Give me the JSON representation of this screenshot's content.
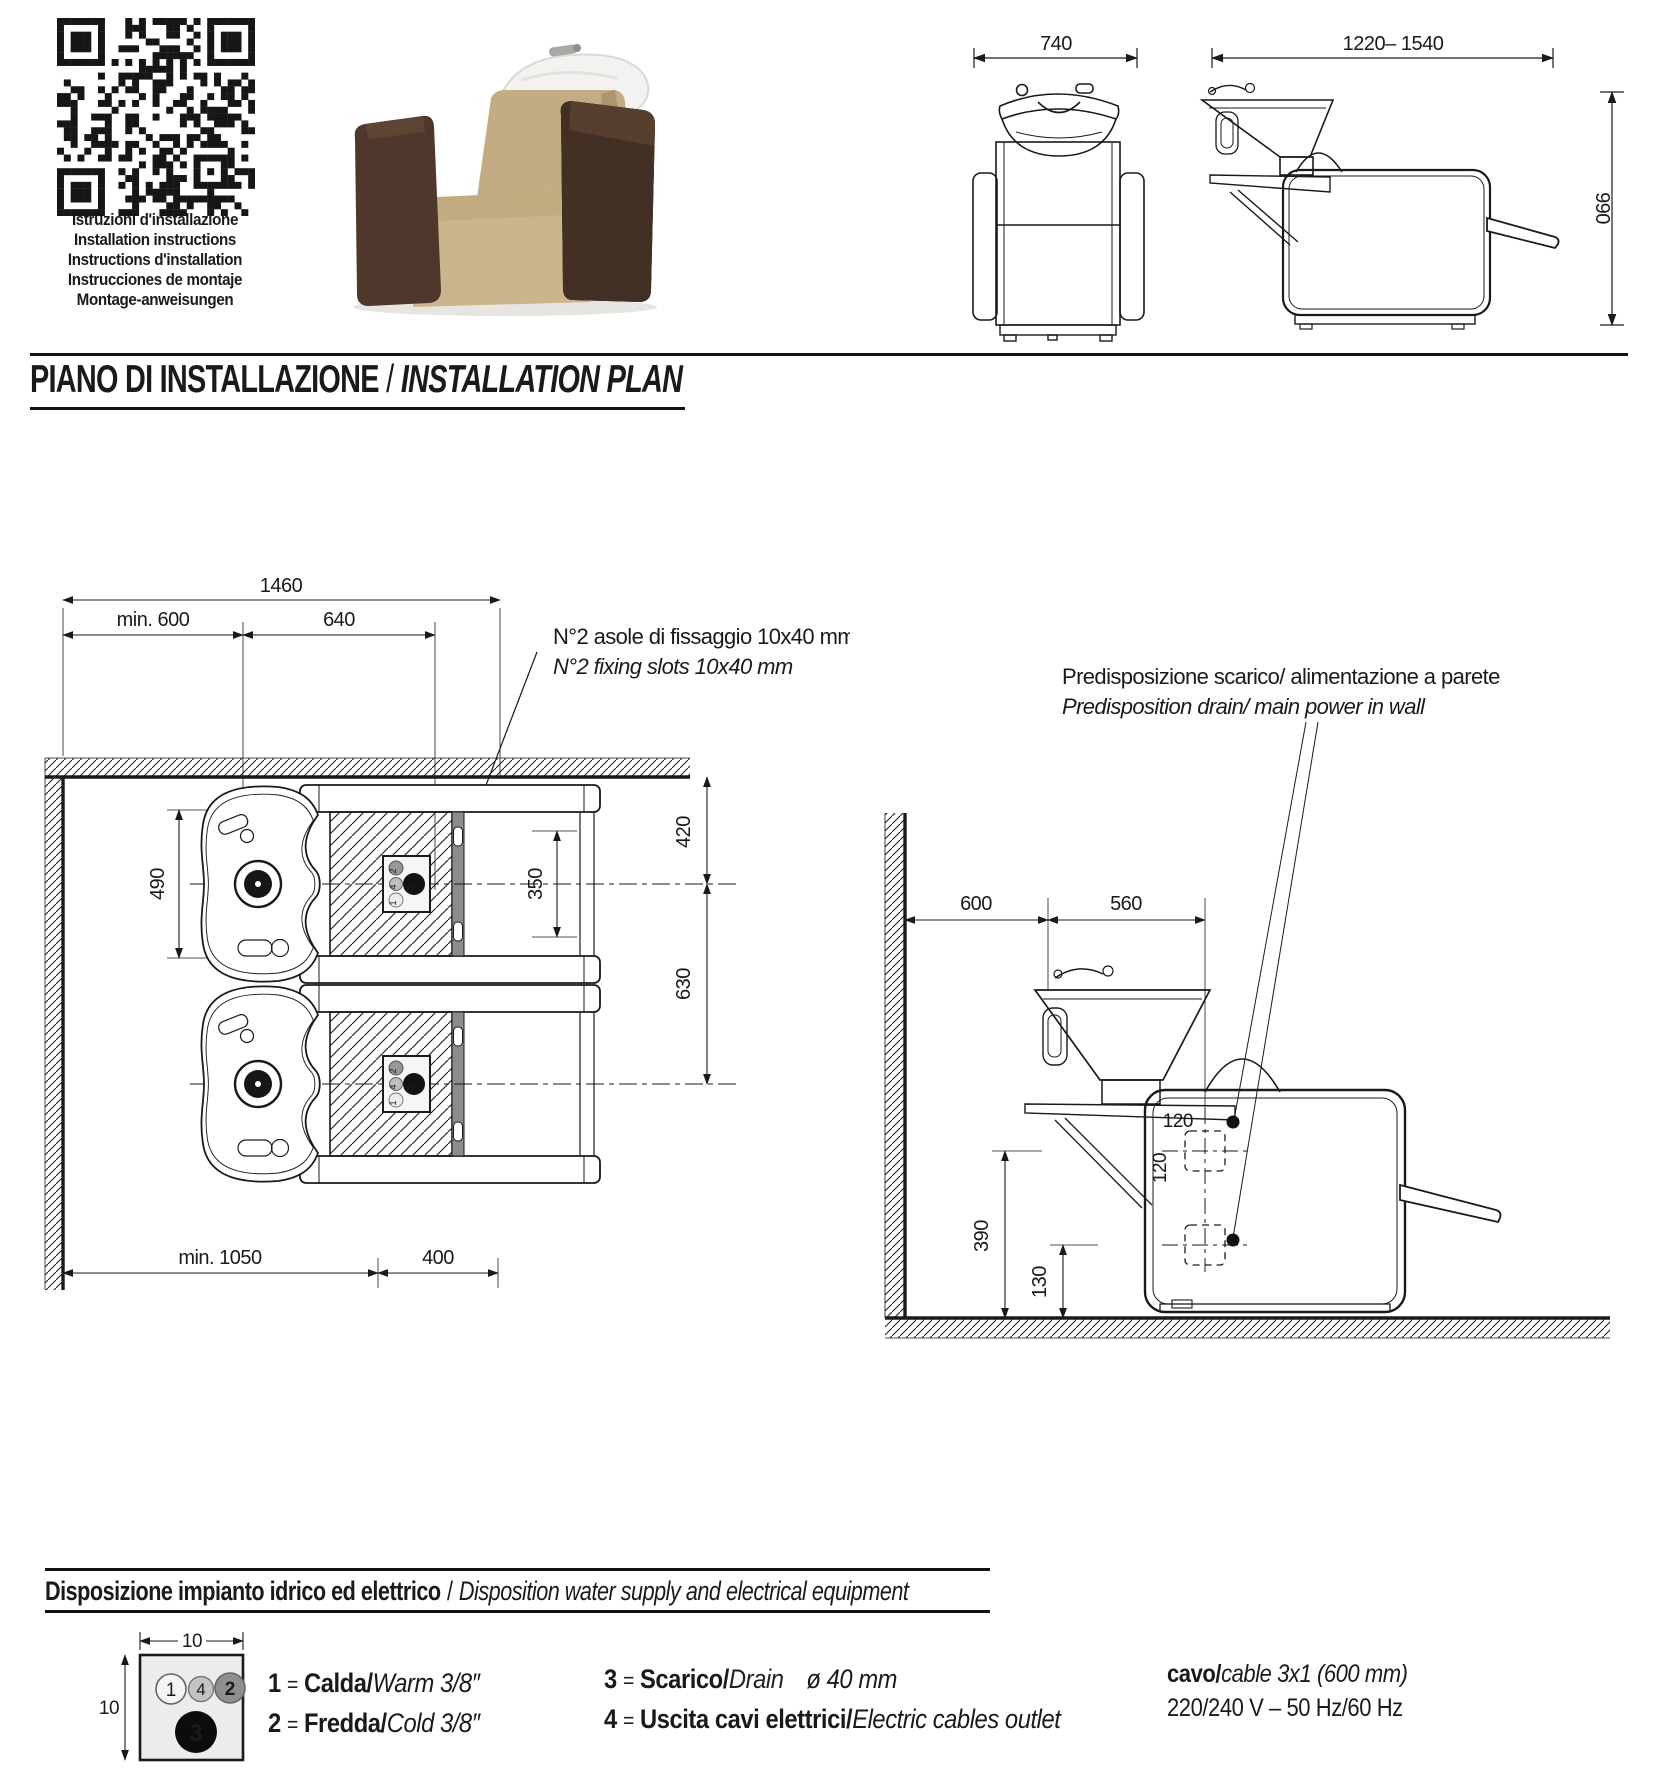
{
  "header": {
    "qr_caption": [
      "Istruzioni d'installazione",
      "Installation instructions",
      "Instructions d'installation",
      "Instrucciones de montaje",
      "Montage-anweisungen"
    ],
    "front_view": {
      "width": "740"
    },
    "side_view": {
      "width": "1220– 1540",
      "height": "990"
    }
  },
  "title": {
    "it": "PIANO DI INSTALLAZIONE",
    "sep": "/",
    "en": "INSTALLATION PLAN"
  },
  "plan": {
    "callout": [
      "N°2 asole di fissaggio 10x40 mm",
      "N°2 fixing slots 10x40 mm"
    ],
    "dims": {
      "total": "1460",
      "wall_gap": "min. 600",
      "offset": "640",
      "basin": "490",
      "to_center": "420",
      "spacing": "630",
      "slots": "350",
      "front": "min. 1050",
      "depth": "400"
    }
  },
  "side": {
    "callout": [
      "Predisposizione scarico/ alimentazione a parete",
      "Predisposition drain/ main power in wall"
    ],
    "dims": {
      "wall": "600",
      "basin": "560",
      "out_h": "120",
      "out_v": "120",
      "upper": "390",
      "lower": "130"
    }
  },
  "section2": {
    "it": "Disposizione impianto idrico ed elettrico",
    "sep": "/",
    "en": "Disposition water supply and electrical equipment"
  },
  "legend": {
    "diagram": {
      "width": "10",
      "height": "10",
      "connections": [
        "1",
        "4",
        "2",
        "3"
      ]
    },
    "items": [
      {
        "num": "1",
        "eq": "=",
        "it": "Calda/",
        "en": "Warm 3/8″"
      },
      {
        "num": "2",
        "eq": "=",
        "it": "Fredda/",
        "en": "Cold 3/8″"
      },
      {
        "num": "3",
        "eq": "=",
        "it": "Scarico/",
        "en": "Drain",
        "extra": "ø 40 mm"
      },
      {
        "num": "4",
        "eq": "=",
        "it": "Uscita cavi elettrici/",
        "en": "Electric cables outlet"
      }
    ],
    "cable_it": "cavo/",
    "cable_en": "cable 3x1 (600 mm)",
    "power": "220/240 V – 50 Hz/60 Hz"
  }
}
